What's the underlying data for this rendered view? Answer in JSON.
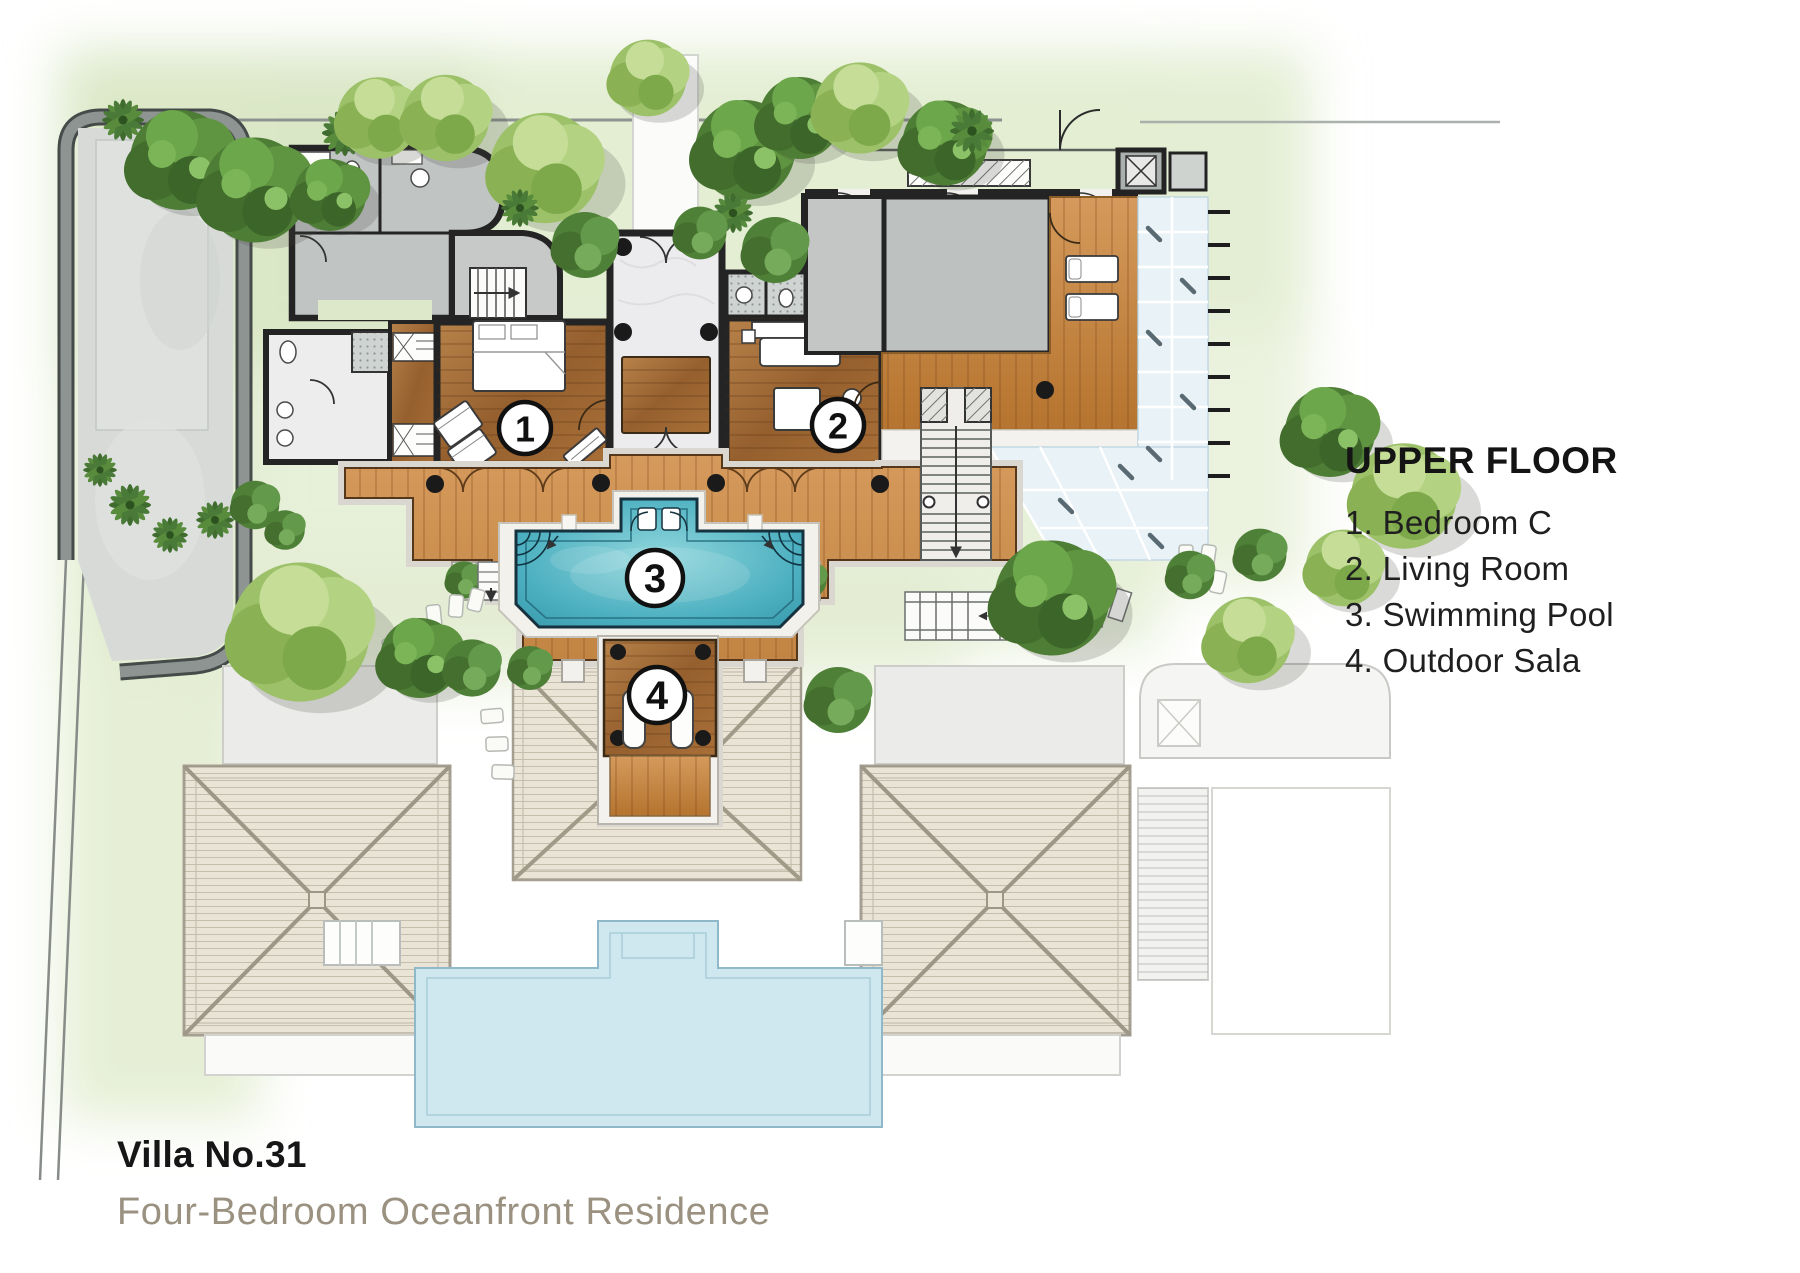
{
  "legend": {
    "title": "UPPER FLOOR",
    "items": [
      "1. Bedroom C",
      "2. Living Room",
      "3. Swimming Pool",
      "4. Outdoor Sala"
    ]
  },
  "title_block": {
    "name": "Villa No.31",
    "subtitle": "Four-Bedroom Oceanfront Residence"
  },
  "plan": {
    "markers": [
      "1",
      "2",
      "3",
      "4"
    ]
  },
  "palette": {
    "pool_water": "#3fb0bf",
    "terrace_wood": "#c9873f",
    "room_wood": "#a8703a",
    "gray_room": "#bdc1c0",
    "glass_roof": "#e8f2f7",
    "lower_roof": "#e9e4d6",
    "ghost_pool": "#cfe7ef",
    "green_wash": "#e3edd2",
    "subtitle_text": "#9a9180"
  }
}
